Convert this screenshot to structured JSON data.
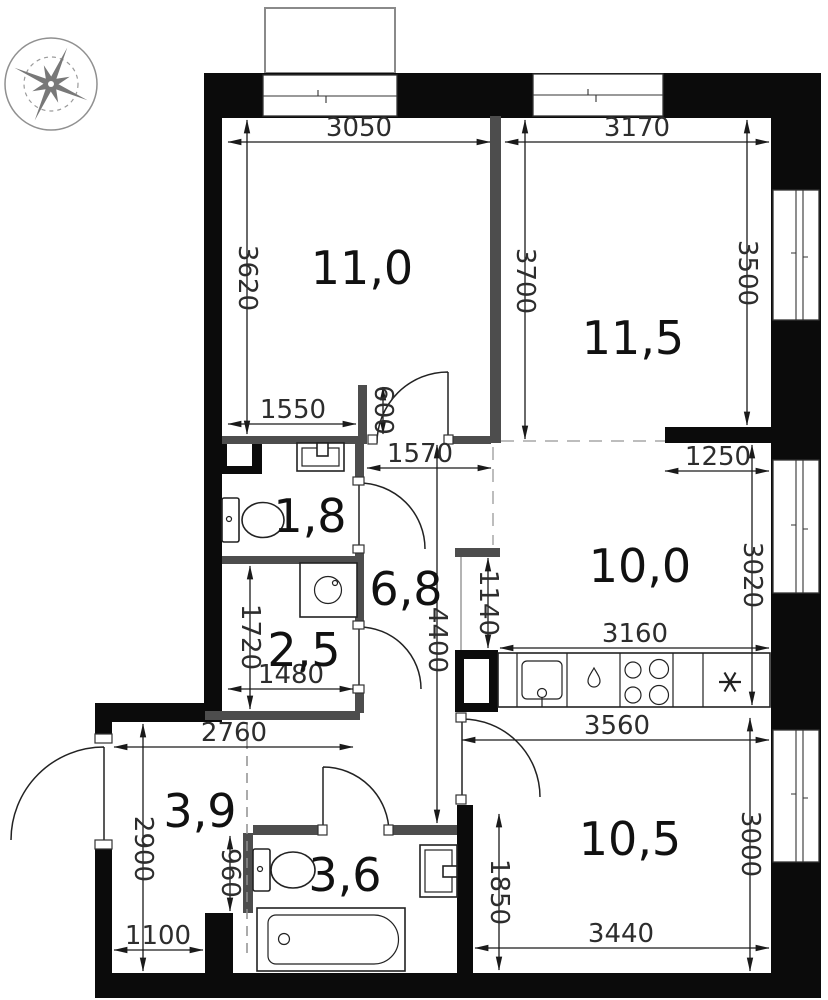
{
  "compass": {
    "north": "С",
    "south": "Ю",
    "west": "З",
    "east": "В"
  },
  "areas": {
    "r110": "11,0",
    "r115": "11,5",
    "r18": "1,8",
    "r68": "6,8",
    "r25": "2,5",
    "r100": "10,0",
    "r39": "3,9",
    "r36": "3,6",
    "r105": "10,5"
  },
  "dims": {
    "d3050": "3050",
    "d3170": "3170",
    "d3620": "3620",
    "d3700": "3700",
    "d3500": "3500",
    "d1550": "1550",
    "d600": "600",
    "d1570": "1570",
    "d1250": "1250",
    "d3020": "3020",
    "d1140": "1140",
    "d4400": "4400",
    "d3160": "3160",
    "d1720": "1720",
    "d1480": "1480",
    "d2760": "2760",
    "d3560": "3560",
    "d2900": "2900",
    "d960": "960",
    "d1100": "1100",
    "d1850": "1850",
    "d3440": "3440",
    "d3000": "3000"
  }
}
